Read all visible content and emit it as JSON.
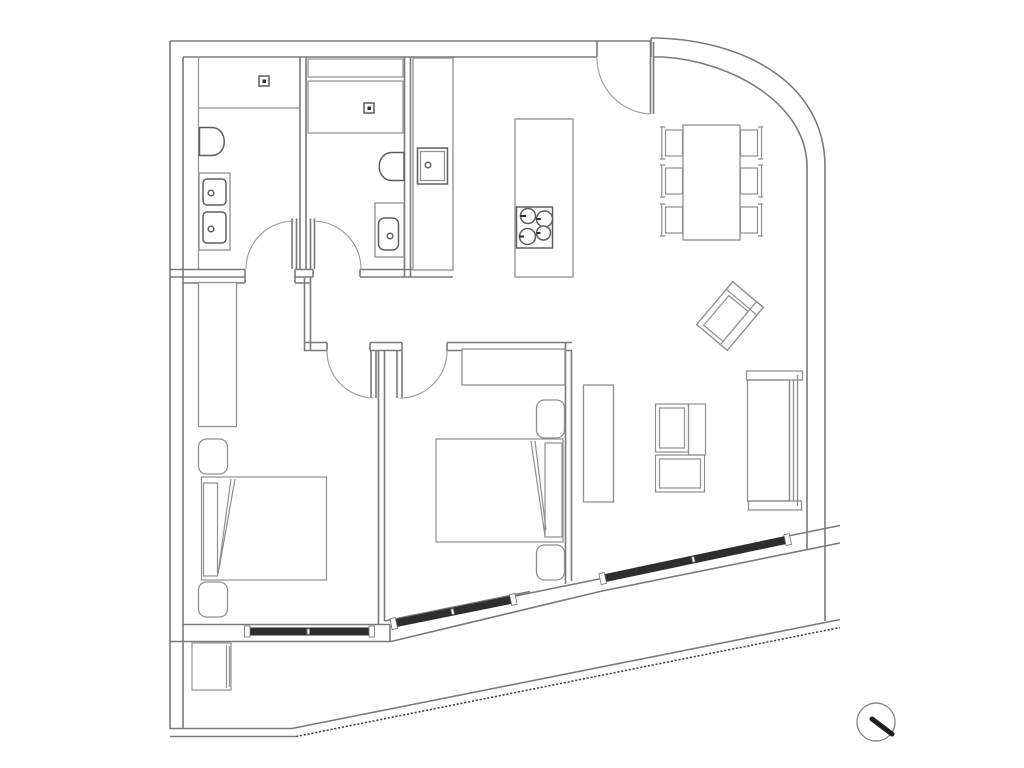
{
  "meta": {
    "type": "architectural-floor-plan",
    "style": "black-and-white CAD line drawing",
    "background_color": "#ffffff"
  },
  "palette": {
    "wall_line": "#7a7a7a",
    "furniture_line": "#8f8f8f",
    "fixture_line": "#5f5f5f",
    "window_band": "#2e2e2e",
    "symbol_dark": "#1f1f1f"
  },
  "rooms": {
    "bathroom1": {
      "label": "En-suite bathroom with shower, toilet and double-sink vanity"
    },
    "bathroom2": {
      "label": "Second bathroom with shower, toilet and sink"
    },
    "kitchen": {
      "label": "Kitchen with counter, sink and cooktop island"
    },
    "dining": {
      "label": "Dining area with table and six chairs"
    },
    "living": {
      "label": "Living room with sofa, armchair and media unit"
    },
    "bedroom1": {
      "label": "Bedroom 1 with double bed, wardrobe and nightstands"
    },
    "bedroom2": {
      "label": "Bedroom 2 with double bed, wardrobe and nightstands"
    },
    "hallway": {
      "label": "Hallway / vestibule connecting rooms"
    },
    "terrace": {
      "label": "Terrace along the angled facade"
    }
  },
  "fixtures": {
    "entry_door": {
      "label": "Entry door with swing arc"
    },
    "windows": {
      "label": "Three glazed window bands on facade",
      "count": 3
    },
    "shower_drains": {
      "label": "Shower drain squares",
      "count": 2
    },
    "compass": {
      "label": "Surveyor circle symbol with needle"
    }
  },
  "furniture": {
    "island": {
      "label": "Kitchen island with 4-burner cooktop"
    },
    "table": {
      "label": "Dining table"
    },
    "chairs": {
      "label": "Dining chairs",
      "count": 6
    },
    "armchair": {
      "label": "Rotated armchair"
    },
    "sofa": {
      "label": "Sofa against right wall"
    },
    "media_unit": {
      "label": "TV / media cabinet"
    },
    "sideboard": {
      "label": "Low sideboard"
    },
    "beds": {
      "label": "Double beds",
      "count": 2
    },
    "wardrobes": {
      "label": "Wardrobes",
      "count": 2
    },
    "planter": {
      "label": "Terrace planter box"
    }
  }
}
